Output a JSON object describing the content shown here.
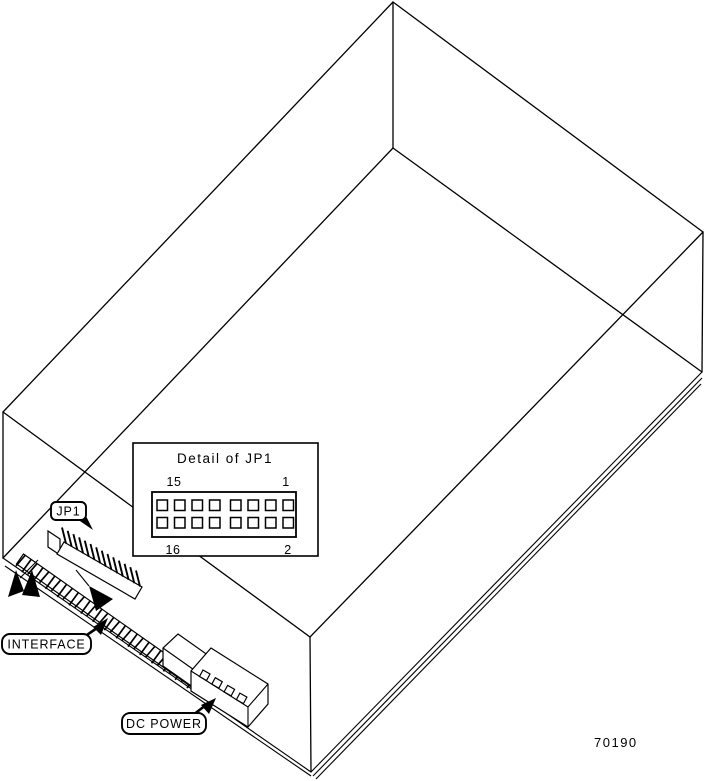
{
  "figure": {
    "part_number": "70190",
    "callouts": {
      "jp1": "JP1",
      "interface": "INTERFACE",
      "dc_power": "DC POWER"
    },
    "detail_inset": {
      "title": "Detail of JP1",
      "corner_pins": {
        "top_left": "15",
        "top_right": "1",
        "bottom_left": "16",
        "bottom_right": "2"
      },
      "pin_rows": 2,
      "pins_per_row": 8
    },
    "connectors": {
      "jp1_pin_count": 14,
      "interface_pin_count": 30,
      "dc_power_pin_count": 4
    }
  }
}
